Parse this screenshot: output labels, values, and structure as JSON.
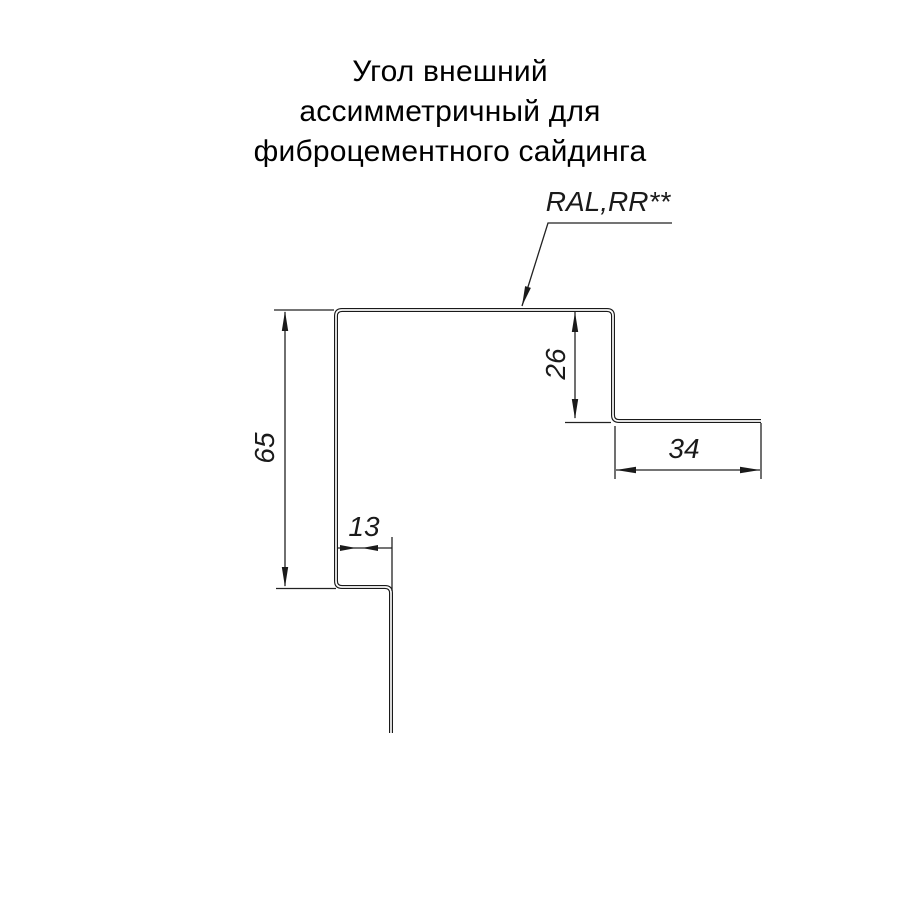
{
  "title": {
    "line1": "Угол внешний",
    "line2": "ассимметричный для",
    "line3": "фиброцементного сайдинга"
  },
  "drawing": {
    "kind": "sheet-metal profile cross-section",
    "coating_label": "RAL,RR**",
    "dimensions": [
      {
        "name": "left-vertical-height",
        "value": "65"
      },
      {
        "name": "right-vertical-drop",
        "value": "26"
      },
      {
        "name": "right-horizontal-flange",
        "value": "34"
      },
      {
        "name": "bottom-horizontal-step",
        "value": "13"
      }
    ],
    "colors": {
      "background": "#ffffff",
      "line": "#1a1a1a",
      "text": "#000000"
    }
  }
}
